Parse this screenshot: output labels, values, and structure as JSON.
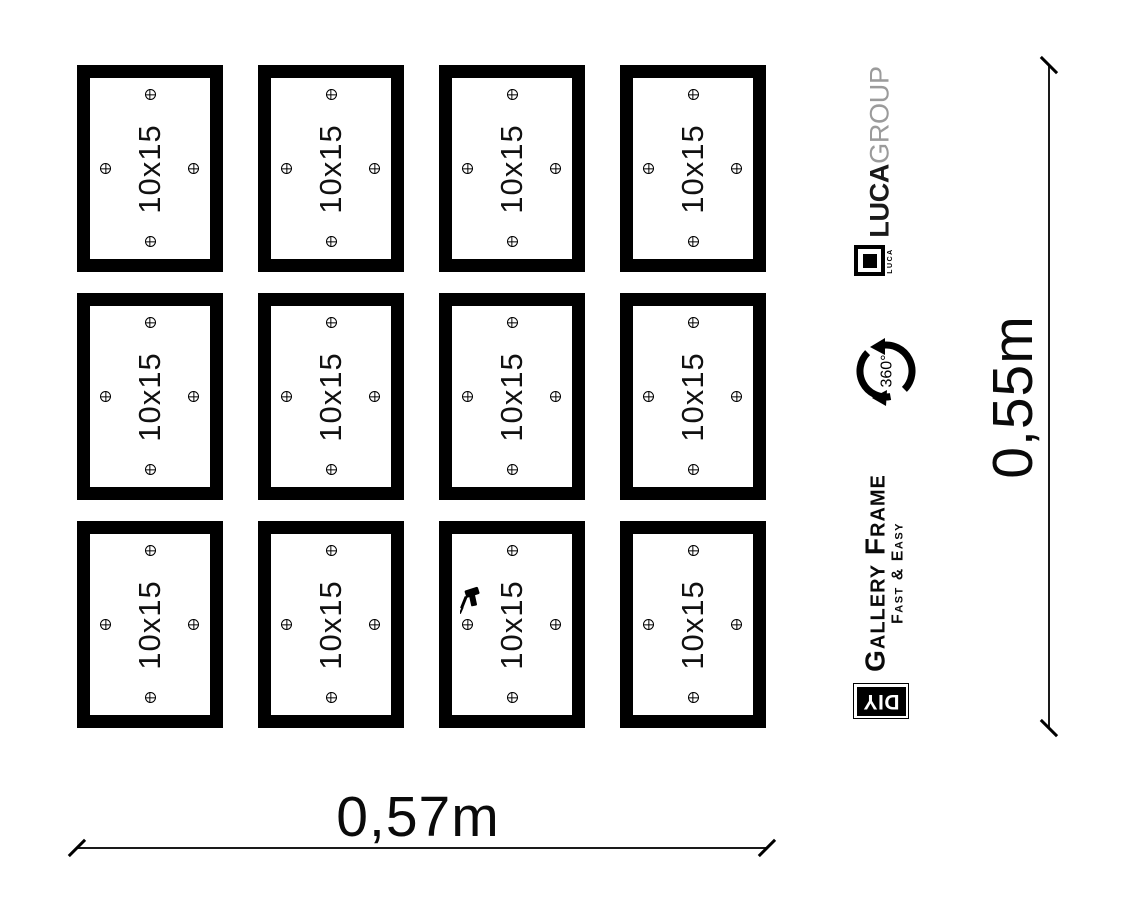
{
  "canvas": {
    "width_px": 1123,
    "height_px": 905,
    "background": "#ffffff",
    "ink": "#000000"
  },
  "grid": {
    "rows": 3,
    "cols": 4,
    "count": 12,
    "frame_label": "10x15",
    "mount_point_icons": [
      "crosshair-top-center",
      "crosshair-middle-left",
      "crosshair-middle-right",
      "crosshair-bottom-center"
    ],
    "drill_frame_index": 10
  },
  "dimensions": {
    "width_label": "0,57m",
    "height_label": "0,55m"
  },
  "branding": {
    "group_name_bold": "LUCA",
    "group_name_light": "GROUP",
    "group_light_color": "#9b9b9b",
    "logo_caption": "LUCA",
    "rotation_label": "360°",
    "product_name": "Gallery Frame",
    "product_tagline": "Fast & Easy",
    "diy_label": "DIY"
  }
}
